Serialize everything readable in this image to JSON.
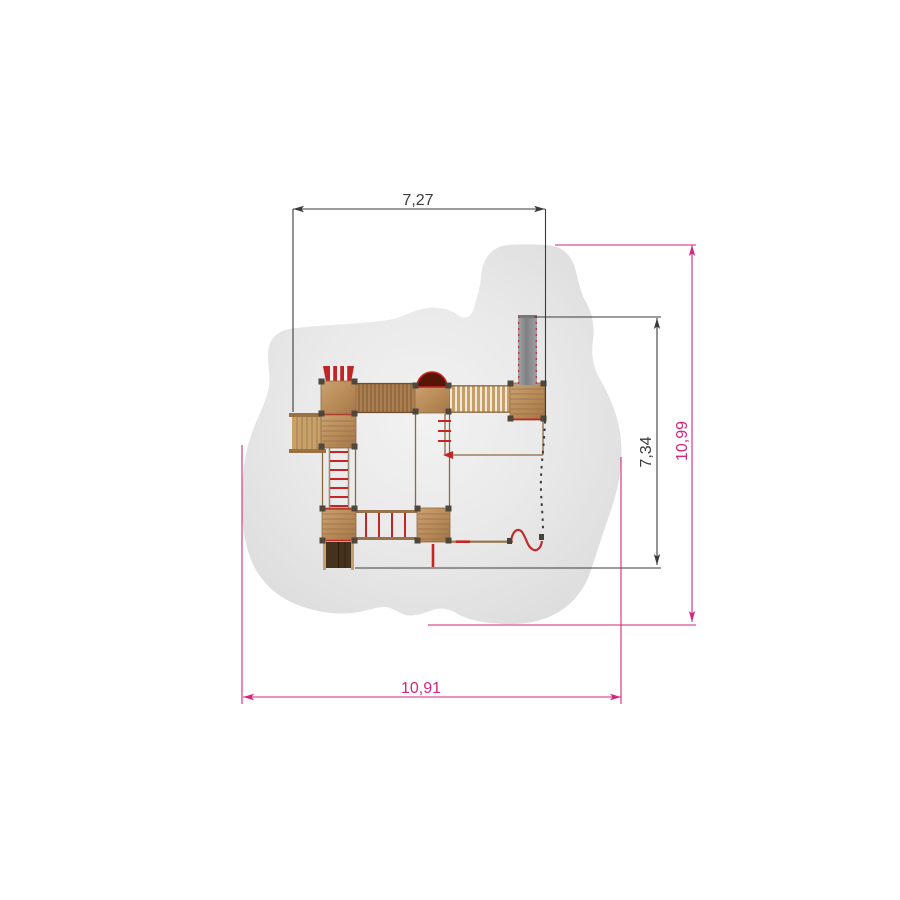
{
  "drawing": {
    "title": "playground-equipment-plan-view",
    "dimensions": [
      {
        "id": "top-width",
        "value": "7,27",
        "orientation": "horizontal",
        "style": "dark"
      },
      {
        "id": "inner-height",
        "value": "7,34",
        "orientation": "vertical",
        "style": "dark"
      },
      {
        "id": "outer-height",
        "value": "10,99",
        "orientation": "vertical",
        "style": "magenta"
      },
      {
        "id": "outer-width",
        "value": "10,91",
        "orientation": "horizontal",
        "style": "magenta"
      }
    ],
    "colors": {
      "dim_dark": "#3b3b3b",
      "dim_magenta": "#d4267d",
      "safety_zone_edge": "#dedede",
      "safety_zone_center": "#f2f2f2",
      "wood_light": "#cba272",
      "wood_base": "#ab7f4f",
      "wood_dark": "#7d5a36",
      "red_accent": "#c52525",
      "arch_fill": "#551608",
      "slide_gray": "#8f9093",
      "dark_slide": "#46311d",
      "background": "#ffffff"
    },
    "equipment": [
      "safety-zone",
      "tower-with-striped-roof",
      "access-steps",
      "plank-bridge",
      "arch-tunnel-platform",
      "rope-bridge",
      "gray-slide",
      "rope-ladder",
      "monkey-bars",
      "lower-platforms",
      "dark-slide",
      "fireman-pole",
      "wavy-climber",
      "hidden-edge"
    ]
  }
}
